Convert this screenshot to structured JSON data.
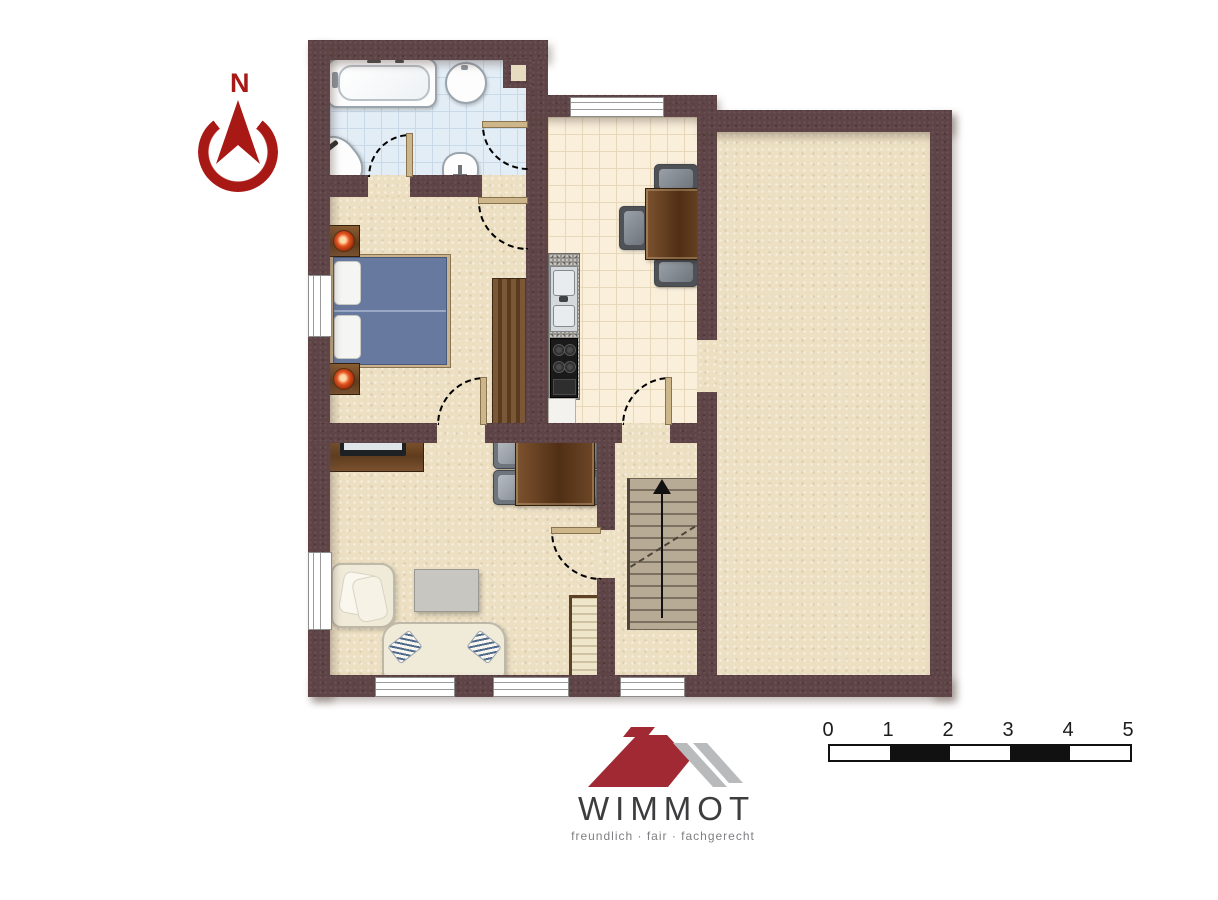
{
  "compass": {
    "label": "N"
  },
  "logo": {
    "name": "WIMMOT",
    "tagline": "freundlich · fair · fachgerecht"
  },
  "scale_bar": {
    "tick_labels": [
      "0",
      "1",
      "2",
      "3",
      "4",
      "5"
    ]
  },
  "stairs": {
    "direction": "up"
  },
  "colors": {
    "wall": "#5e4446",
    "floor_beige": "#ecdfc2",
    "bathroom_tile": "#e3edf5",
    "kitchen_tile": "#f9efdb",
    "bed_blue": "#68799f",
    "compass_red": "#a81815",
    "logo_red": "#a12934",
    "logo_gray": "#b9babc"
  }
}
